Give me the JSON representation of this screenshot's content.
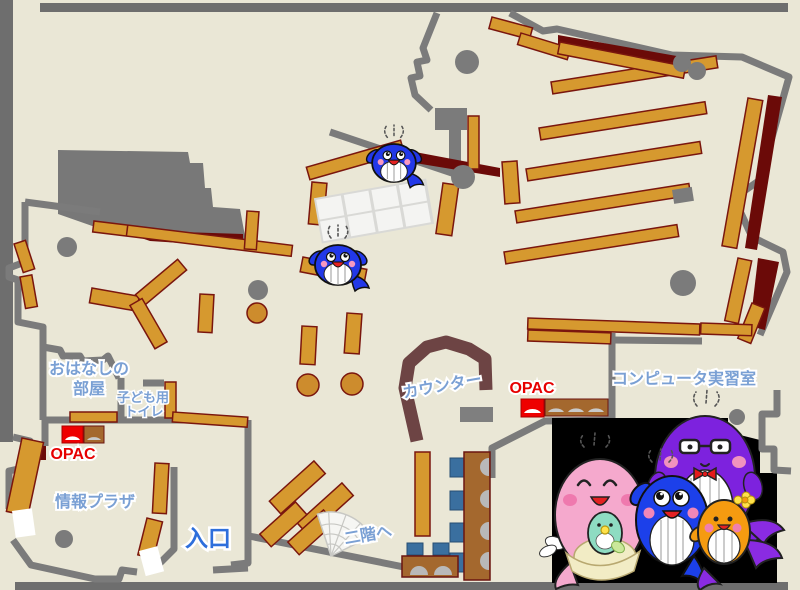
{
  "map": {
    "labels": {
      "storytelling_room_line1": "おはなしの",
      "storytelling_room_line2": "部屋",
      "kids_toilet_line1": "子ども用",
      "kids_toilet_line2": "トイレ",
      "opac_left": "OPAC",
      "opac_right": "OPAC",
      "info_plaza": "情報プラザ",
      "entrance": "入口",
      "to_second_floor": "二階へ",
      "counter": "カウンター",
      "computer_room": "コンピュータ実習室"
    },
    "colors": {
      "floor": "#eae7d6",
      "wall_gray": "#7b7b7b",
      "shelf_orange": "#d6992f",
      "shelf_border": "#7a160e",
      "dark_red_area": "#6b0a08",
      "counter_brown": "#6d4444",
      "desk_brown": "#a4682e",
      "chair_blue": "#3a6f9f",
      "label_light_blue": "#7aa0d4",
      "entrance_blue": "#2e6fdb",
      "opac_red": "#e60000",
      "opac_terminal_red": "#ee0000",
      "photo_background": "#000000",
      "whale_blue": "#2238e8",
      "whale_pink": "#f5a9cd",
      "whale_purple": "#7d22de",
      "whale_orange": "#f59b10",
      "baby_whale_green": "#8edcc2"
    },
    "icons": {
      "whale_mascots_on_map": "whale-mascot-icon",
      "stairs": "stairs-fan-icon",
      "opac_terminal": "opac-terminal-icon",
      "mascot_family_photo": "whale-family-illustration"
    }
  }
}
